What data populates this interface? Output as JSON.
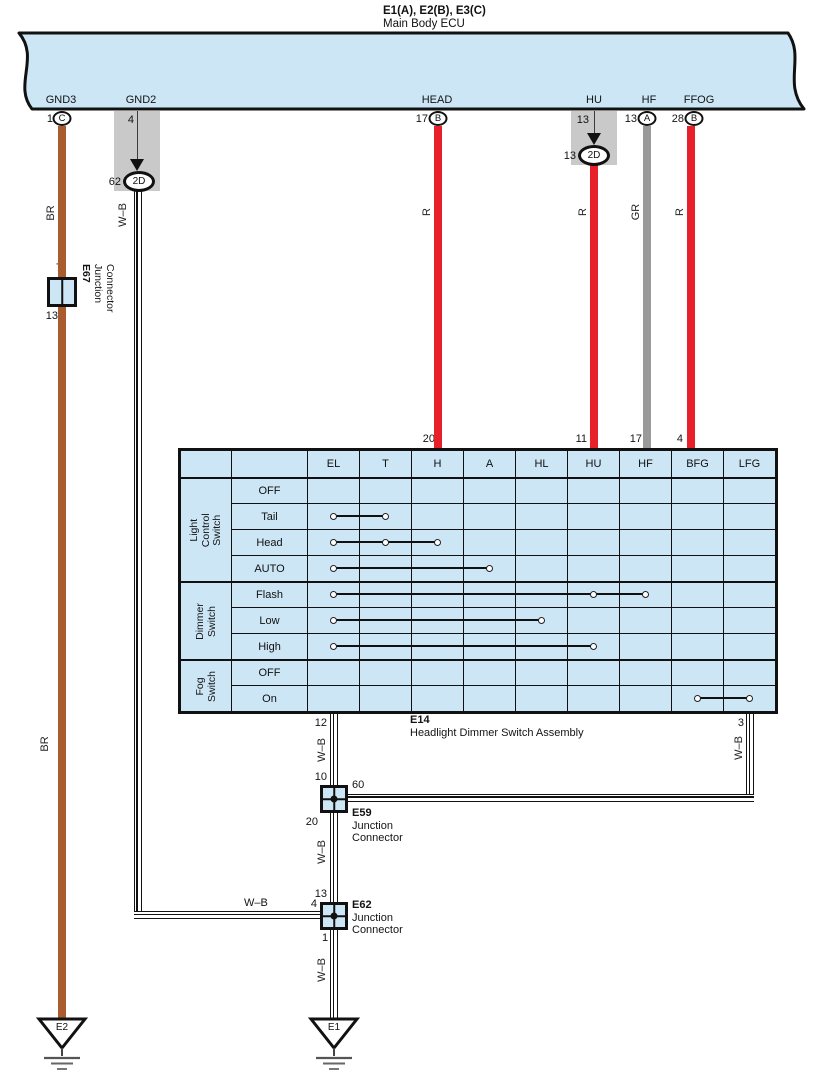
{
  "ecu": {
    "title_line1": "E1(A), E2(B), E3(C)",
    "title_line2": "Main Body ECU",
    "connectors": [
      {
        "name": "GND3",
        "pin": "1",
        "pin_letter": "C"
      },
      {
        "name": "GND2",
        "pin": "4"
      },
      {
        "name": "HEAD",
        "pin": "17",
        "pin_letter": "B"
      },
      {
        "name": "HU",
        "pin": "13"
      },
      {
        "name": "HF",
        "pin": "13",
        "pin_letter": "A"
      },
      {
        "name": "FFOG",
        "pin": "28",
        "pin_letter": "B"
      }
    ]
  },
  "branch_connectors": [
    {
      "pin": "62",
      "id": "2D"
    },
    {
      "pin": "13",
      "id": "2D"
    }
  ],
  "wire_labels": [
    "BR",
    "W–B",
    "R",
    "R",
    "GR",
    "R",
    "BR",
    "W–B",
    "W–B",
    "W–B",
    "W–B",
    "W–B"
  ],
  "junctions": {
    "e67": {
      "id": "E67",
      "name": "Junction\nConnector",
      "pin_top": "7",
      "pin_bottom": "13"
    },
    "e59": {
      "id": "E59",
      "name": "Junction\nConnector",
      "pin_top": "10",
      "pin_right": "60",
      "pin_bottom": "20"
    },
    "e62": {
      "id": "E62",
      "name": "Junction\nConnector",
      "pin_top": "13",
      "pin_left": "4",
      "pin_bottom": "1"
    }
  },
  "switch_table": {
    "assembly_id": "E14",
    "assembly_name": "Headlight Dimmer Switch Assembly",
    "columns": [
      "EL",
      "T",
      "H",
      "A",
      "HL",
      "HU",
      "HF",
      "BFG",
      "LFG"
    ],
    "groups": [
      {
        "name": "Light Control\nSwitch",
        "rows": [
          {
            "label": "OFF",
            "connects": []
          },
          {
            "label": "Tail",
            "connects": [
              "EL",
              "T"
            ]
          },
          {
            "label": "Head",
            "connects": [
              "EL",
              "T",
              "H"
            ]
          },
          {
            "label": "AUTO",
            "connects": [
              "EL",
              "A"
            ]
          }
        ]
      },
      {
        "name": "Dimmer\nSwitch",
        "rows": [
          {
            "label": "Flash",
            "connects": [
              "EL",
              "HU",
              "HF"
            ]
          },
          {
            "label": "Low",
            "connects": [
              "EL",
              "HL"
            ]
          },
          {
            "label": "High",
            "connects": [
              "EL",
              "HU"
            ]
          }
        ]
      },
      {
        "name": "Fog\nSwitch",
        "rows": [
          {
            "label": "OFF",
            "connects": []
          },
          {
            "label": "On",
            "connects": [
              "BFG",
              "LFG"
            ]
          }
        ]
      }
    ],
    "top_pins": [
      {
        "col": "H",
        "pin": "20"
      },
      {
        "col": "HU",
        "pin": "11"
      },
      {
        "col": "HF",
        "pin": "17"
      },
      {
        "col": "BFG",
        "pin": "4"
      }
    ],
    "bottom_pins": [
      {
        "col": "EL",
        "pin": "12"
      },
      {
        "col": "LFG",
        "pin": "3"
      }
    ]
  },
  "grounds": [
    "E2",
    "E1"
  ],
  "colors": {
    "panel_blue": "#cce6f6",
    "band_gray": "#c9c9c9",
    "wire_red": "#e8202a",
    "wire_brown": "#a85c30",
    "wire_gray": "#9a9a9a"
  }
}
